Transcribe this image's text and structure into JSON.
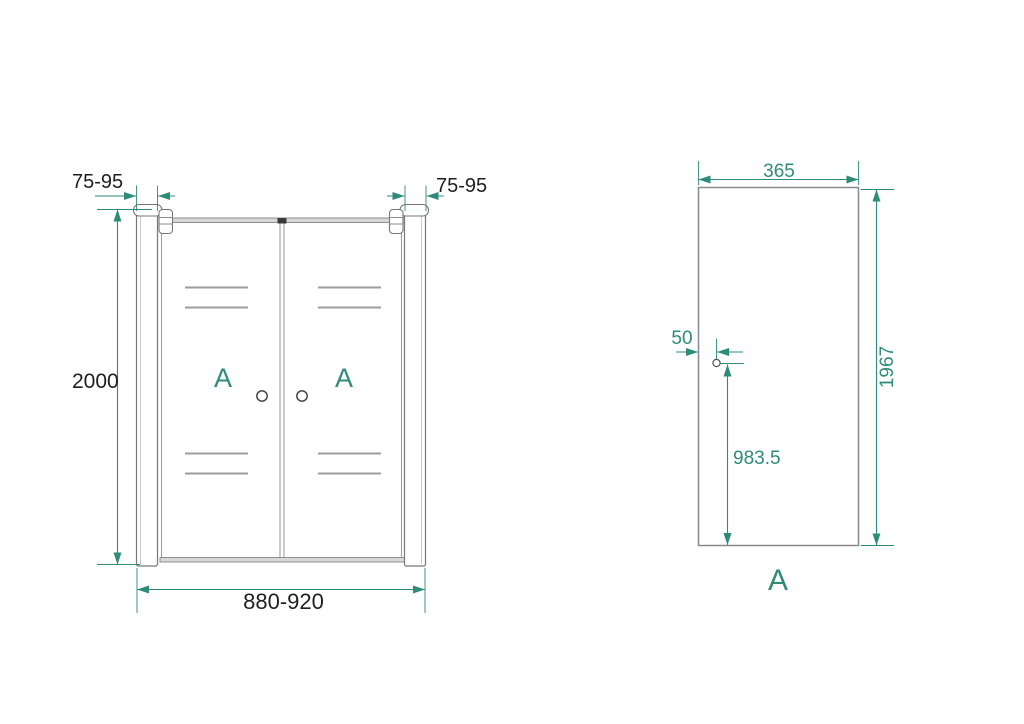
{
  "front_view": {
    "door_label_left": "A",
    "door_label_right": "A",
    "dim_profile_left": "75-95",
    "dim_profile_right": "75-95",
    "dim_height": "2000",
    "dim_width": "880-920"
  },
  "panel_view": {
    "panel_label": "A",
    "dim_width": "365",
    "dim_height": "1967",
    "dim_handle_inset": "50",
    "dim_handle_height": "983.5"
  },
  "colors": {
    "accent_teal": "#2e8b78",
    "line_gray": "#8a8a8a",
    "text_dark": "#1f1f1f",
    "background": "#ffffff"
  }
}
